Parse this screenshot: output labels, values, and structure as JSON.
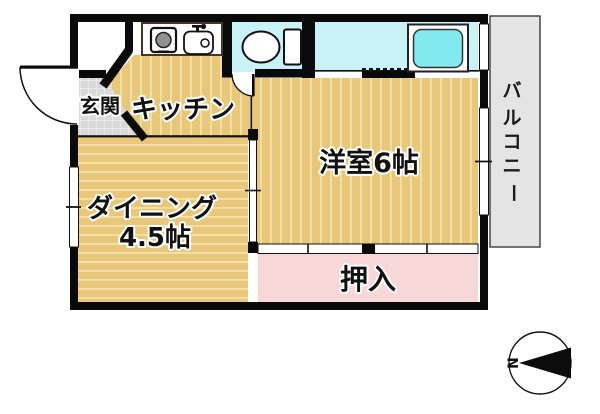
{
  "plan": {
    "rooms": {
      "entrance": {
        "label": "玄関"
      },
      "kitchen": {
        "label": "キッチン"
      },
      "western_room": {
        "label": "洋室6帖"
      },
      "dining": {
        "line1": "ダイニング",
        "line2": "4.5帖"
      },
      "closet": {
        "label": "押入"
      },
      "balcony": {
        "label": "バルコニー",
        "chars": [
          "バ",
          "ル",
          "コ",
          "ニ",
          "ー"
        ]
      }
    },
    "fixtures": {
      "stove": "stove-burner-icon",
      "sink": "kitchen-sink-icon",
      "toilet": "toilet-icon",
      "bathtub": "bathtub-icon"
    },
    "compass": {
      "north_label": "N"
    },
    "colors": {
      "wall": "#0a0a0a",
      "floor_wood": "#e8c77a",
      "floor_stripe": "#f3e2a8",
      "wet_area": "#c9f2f6",
      "tub_water": "#82e9ee",
      "closet_pink": "#f8d7d9",
      "tile_gray": "#d9d9d9",
      "balcony_gray": "#e4e4e4"
    }
  }
}
